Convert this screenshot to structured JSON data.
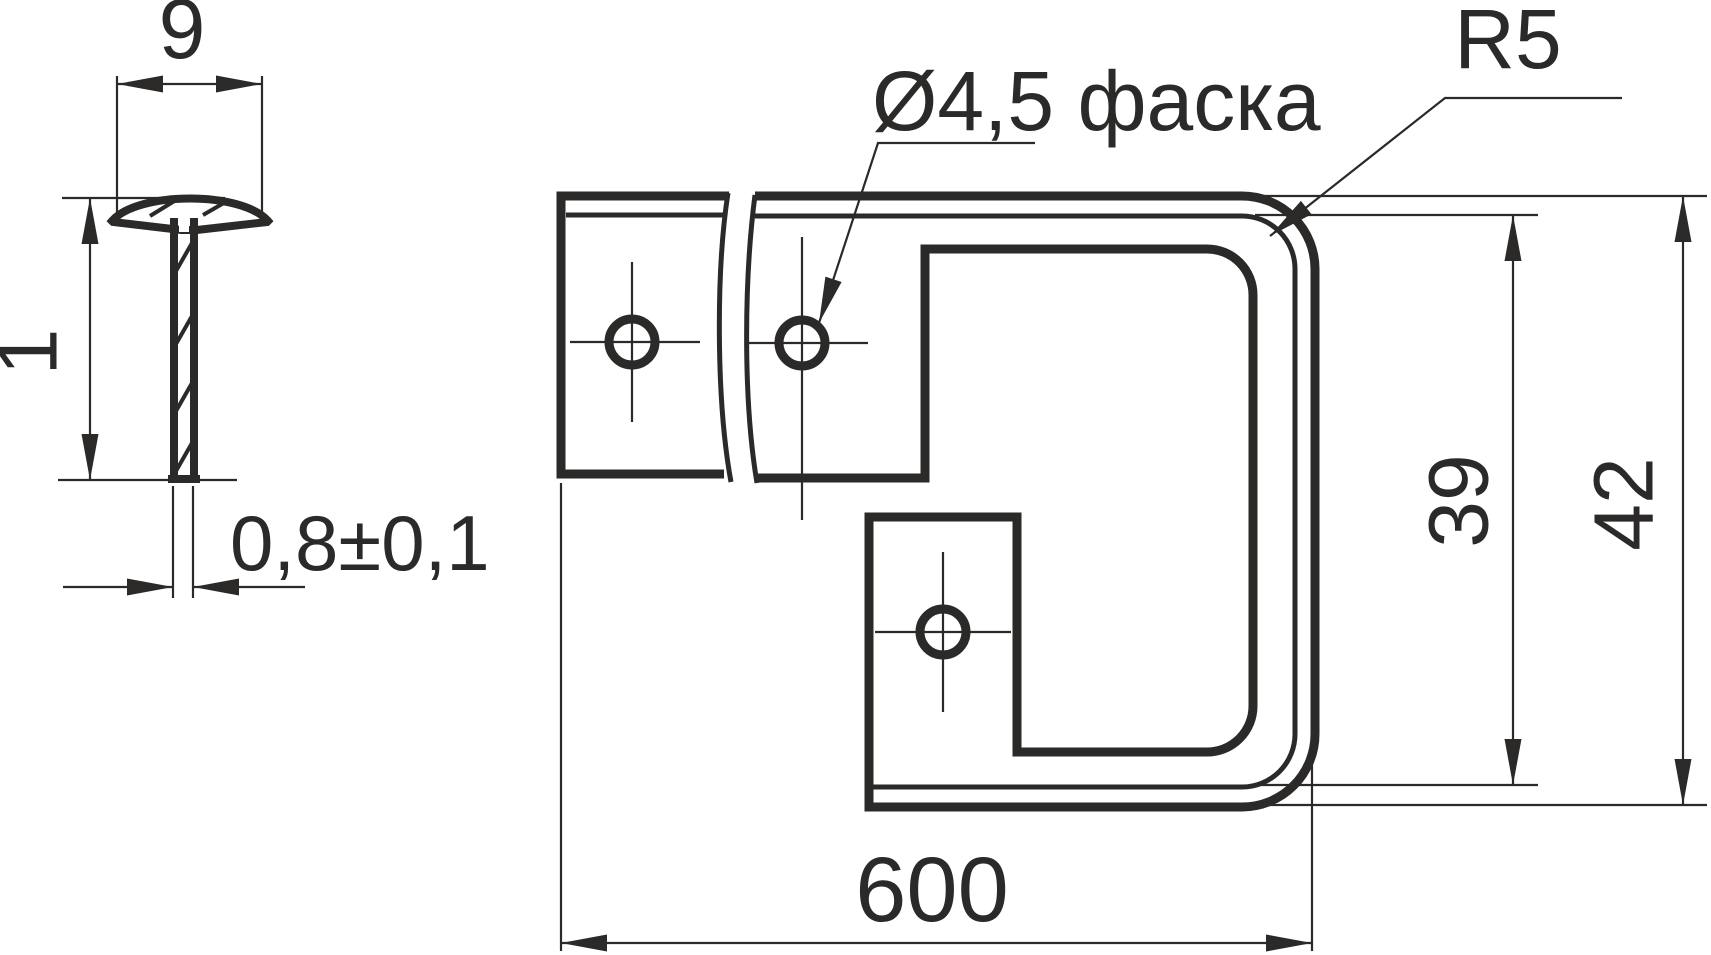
{
  "colors": {
    "ink": "#2b2a29",
    "background": "#ffffff"
  },
  "section_view": {
    "cap_width": "9",
    "profile_height": "1",
    "thickness_tolerance": "0,8±0,1"
  },
  "main_view": {
    "hole_callout": "Ø4,5 фаска",
    "corner_radius": "R5",
    "inner_height": "39",
    "outer_height": "42",
    "overall_length": "600"
  }
}
